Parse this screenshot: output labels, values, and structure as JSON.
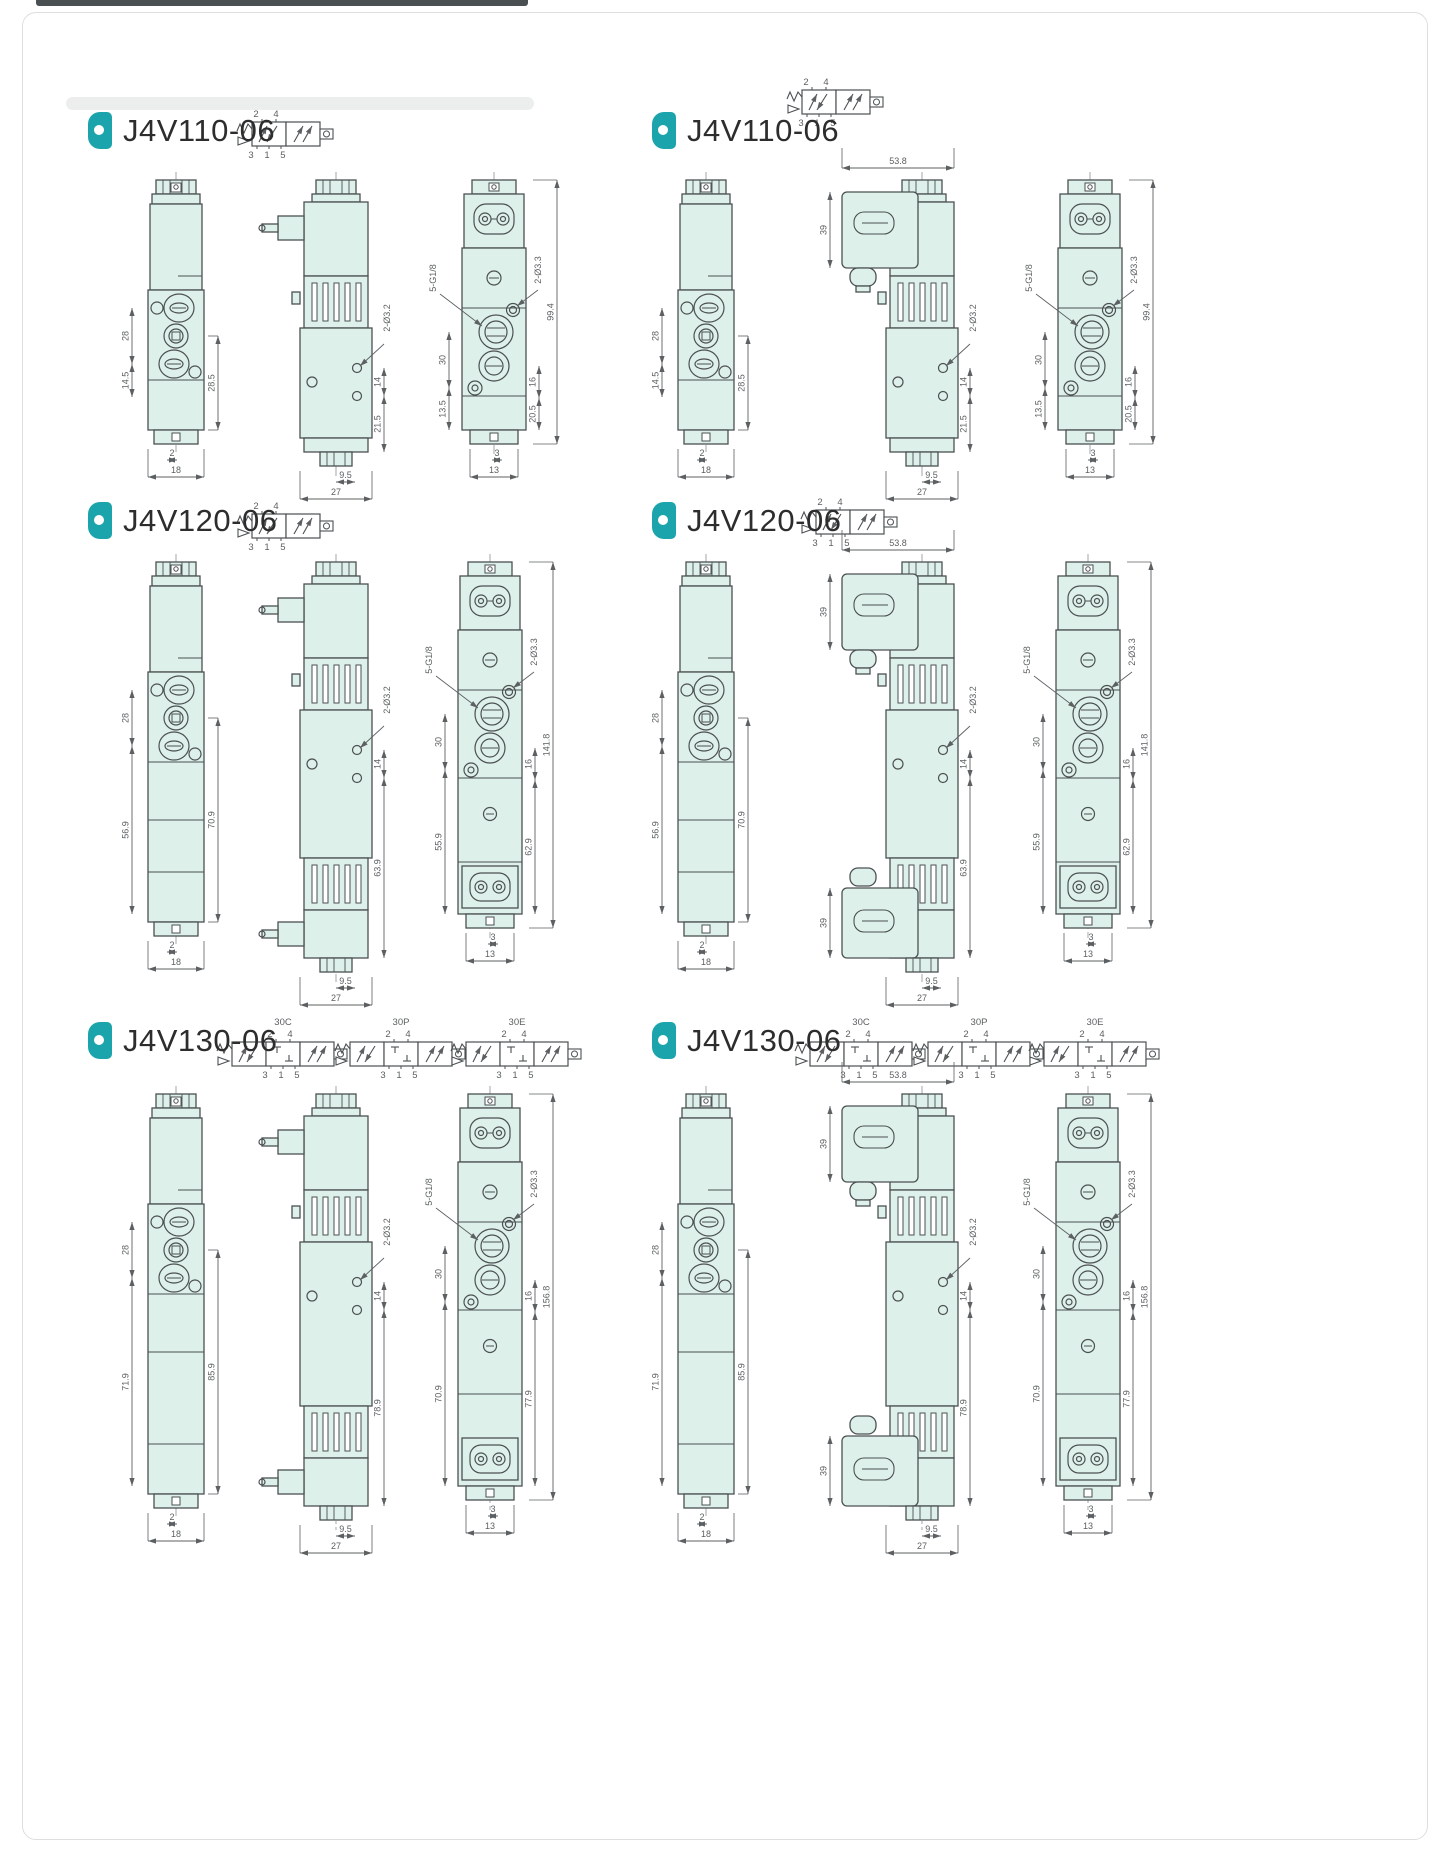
{
  "colors": {
    "accent": "#1ba4ab",
    "body_fill": "#def0ea",
    "line": "#4b5052",
    "dim_text": "#5c6062"
  },
  "panels": [
    {
      "title": "J4V110-06",
      "variant": "v110",
      "solenoid": "pin",
      "symbols": [
        {
          "top": "2 4",
          "bottom": "3 1 5"
        }
      ],
      "dims": {
        "side": {
          "span": "28",
          "lower": "14.5",
          "right": "28.5",
          "offset": "2",
          "width": "18"
        },
        "front": {
          "holes": "2-Ø3.2",
          "gap": "14",
          "lower": "21.5",
          "offset": "9.5",
          "width": "27"
        },
        "end": {
          "ports": "5-G1/8",
          "span": "30",
          "lower": "13.5",
          "holes": "2-Ø3.3",
          "total": "99.4",
          "gap": "16",
          "low2": "20.5",
          "offset": "3",
          "width": "13"
        }
      }
    },
    {
      "title": "J4V110-06",
      "variant": "v110",
      "solenoid": "din",
      "symbols": [
        {
          "top": "2 4",
          "bottom": "3 1 5"
        }
      ],
      "dims": {
        "side": {
          "span": "28",
          "lower": "14.5",
          "right": "28.5",
          "offset": "2",
          "width": "18"
        },
        "front": {
          "top": "53.8",
          "conn": "39",
          "holes": "2-Ø3.2",
          "gap": "14",
          "lower": "21.5",
          "offset": "9.5",
          "width": "27"
        },
        "end": {
          "ports": "5-G1/8",
          "span": "30",
          "lower": "13.5",
          "holes": "2-Ø3.3",
          "total": "99.4",
          "gap": "16",
          "low2": "20.5",
          "offset": "3",
          "width": "13"
        }
      }
    },
    {
      "title": "J4V120-06",
      "variant": "v120",
      "solenoid": "pin",
      "symbols": [
        {
          "top": "2 4",
          "bottom": "3 1 5"
        }
      ],
      "dims": {
        "side": {
          "span": "28",
          "lower": "56.9",
          "right": "70.9",
          "offset": "2",
          "width": "18"
        },
        "front": {
          "holes": "2-Ø3.2",
          "gap": "14",
          "lower": "63.9",
          "offset": "9.5",
          "width": "27"
        },
        "end": {
          "ports": "5-G1/8",
          "span": "30",
          "lower": "55.9",
          "holes": "2-Ø3.3",
          "total": "141.8",
          "gap": "16",
          "low2": "62.9",
          "offset": "3",
          "width": "13"
        }
      }
    },
    {
      "title": "J4V120-06",
      "variant": "v120",
      "solenoid": "din",
      "symbols": [
        {
          "top": "2 4",
          "bottom": "3 1 5"
        }
      ],
      "dims": {
        "side": {
          "span": "28",
          "lower": "56.9",
          "right": "70.9",
          "offset": "2",
          "width": "18"
        },
        "front": {
          "top": "53.8",
          "conn": "39",
          "conn2": "39",
          "holes": "2-Ø3.2",
          "gap": "14",
          "lower": "63.9",
          "offset": "9.5",
          "width": "27"
        },
        "end": {
          "ports": "5-G1/8",
          "span": "30",
          "lower": "55.9",
          "holes": "2-Ø3.3",
          "total": "141.8",
          "gap": "16",
          "low2": "62.9",
          "offset": "3",
          "width": "13"
        }
      }
    },
    {
      "title": "J4V130-06",
      "variant": "v130",
      "solenoid": "pin",
      "symbols": [
        {
          "label": "30C",
          "top": "2 4",
          "bottom": "3 1 5"
        },
        {
          "label": "30P",
          "top": "2 4",
          "bottom": "3 1 5"
        },
        {
          "label": "30E",
          "top": "2 4",
          "bottom": "3 1 5"
        }
      ],
      "dims": {
        "side": {
          "span": "28",
          "lower": "71.9",
          "right": "85.9",
          "offset": "2",
          "width": "18"
        },
        "front": {
          "holes": "2-Ø3.2",
          "gap": "14",
          "lower": "78.9",
          "offset": "9.5",
          "width": "27"
        },
        "end": {
          "ports": "5-G1/8",
          "span": "30",
          "lower": "70.9",
          "holes": "2-Ø3.3",
          "total": "156.8",
          "gap": "16",
          "low2": "77.9",
          "offset": "3",
          "width": "13"
        }
      }
    },
    {
      "title": "J4V130-06",
      "variant": "v130",
      "solenoid": "din",
      "symbols": [
        {
          "label": "30C",
          "top": "2 4",
          "bottom": "3 1 5"
        },
        {
          "label": "30P",
          "top": "2 4",
          "bottom": "3 1 5"
        },
        {
          "label": "30E",
          "top": "2 4",
          "bottom": "3 1 5"
        }
      ],
      "dims": {
        "side": {
          "span": "28",
          "lower": "71.9",
          "right": "85.9",
          "offset": "2",
          "width": "18"
        },
        "front": {
          "top": "53.8",
          "conn": "39",
          "conn2": "39",
          "holes": "2-Ø3.2",
          "gap": "14",
          "lower": "78.9",
          "offset": "9.5",
          "width": "27"
        },
        "end": {
          "ports": "5-G1/8",
          "span": "30",
          "lower": "70.9",
          "holes": "2-Ø3.3",
          "total": "156.8",
          "gap": "16",
          "low2": "77.9",
          "offset": "3",
          "width": "13"
        }
      }
    }
  ]
}
